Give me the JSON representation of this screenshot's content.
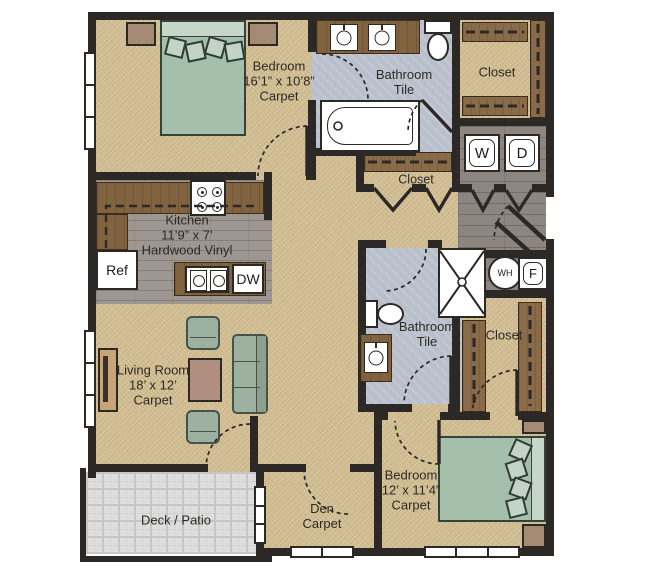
{
  "plan_title": "Two bedroom two bath apartment floor plan",
  "colors": {
    "wall": "#2b2826",
    "carpet": "#d3bf94",
    "tile": "#b9c0cb",
    "hardwood": "#8d8580",
    "counter_wood": "#82633f",
    "furniture_green": "#9db1a1",
    "deck": "#dedede"
  },
  "rooms": {
    "bedroom1": {
      "name": "Bedroom",
      "dims": "16’1” x 10’8”",
      "floor": "Carpet"
    },
    "bathroom1": {
      "name": "Bathroom",
      "floor": "Tile"
    },
    "closet_top": {
      "name": "Closet"
    },
    "closet_hall": {
      "name": "Closet"
    },
    "closet_bedroom2": {
      "name": "Closet"
    },
    "kitchen": {
      "name": "Kitchen",
      "dims": "11’9” x 7’",
      "floor": "Hardwood Vinyl"
    },
    "living_room": {
      "name": "Living Room",
      "dims": "18’ x 12’",
      "floor": "Carpet"
    },
    "bathroom2": {
      "name": "Bathroom",
      "floor": "Tile"
    },
    "bedroom2": {
      "name": "Bedroom",
      "dims": "12’ x 11’4”",
      "floor": "Carpet"
    },
    "den": {
      "name": "Den",
      "floor": "Carpet"
    },
    "deck": {
      "name": "Deck / Patio"
    }
  },
  "appliances": {
    "refrigerator": "Ref",
    "dishwasher": "DW",
    "washer": "W",
    "dryer": "D",
    "water_heater": "WH",
    "furnace": "F"
  }
}
